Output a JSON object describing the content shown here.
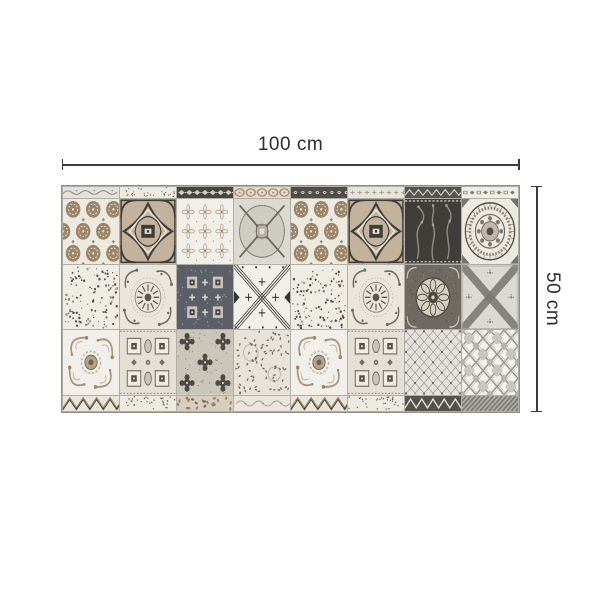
{
  "figure": {
    "width_label": "100 cm",
    "height_label": "50 cm",
    "line_color": "#3c3c3c",
    "text_color": "#2d2d2d",
    "background": "#ffffff"
  },
  "mat": {
    "description": "patchwork-cement-tile-mat",
    "columns": 8,
    "palette": {
      "grout": "#b0aea6",
      "mat_border": "#8f8e88",
      "cream": "#ece9e1",
      "offwhite": "#f1efe9",
      "taupe": "#9c8468",
      "tan": "#c3b29c",
      "brown": "#8a7258",
      "charcoal": "#3f3d38",
      "dark": "#45433d",
      "slate": "#5d5f68",
      "gray": "#8a887f",
      "lightgray": "#d9d6cd",
      "sage": "#6b695f",
      "ecru": "#e8e0d2",
      "stone": "#cfccc2"
    },
    "rows": [
      {
        "kind": "strip",
        "pattern_cells": [
          "st-scroll",
          "st-speckle",
          "st-darkdiamond",
          "st-circles",
          "st-darkfloret",
          "st-ornate",
          "st-zigzag",
          "st-motifs"
        ]
      },
      {
        "kind": "full",
        "pattern_cells": [
          "rosette-dots",
          "diamond-frame",
          "floral-lattice",
          "compass",
          "rosette-dots",
          "diamond-frame",
          "dark-damask",
          "mandala"
        ]
      },
      {
        "kind": "full",
        "pattern_cells": [
          "speckle",
          "sun-flower",
          "slate-geo",
          "x-arrows",
          "speckle",
          "sun-flower",
          "tapestry",
          "x-speckle"
        ]
      },
      {
        "kind": "full",
        "pattern_cells": [
          "baroque-swirl",
          "coffered",
          "dense-floral",
          "leaf-speckle",
          "baroque-swirl",
          "coffered",
          "mini-diamond",
          "trellis"
        ]
      },
      {
        "kind": "strip",
        "pattern_cells": [
          "chevron",
          "st-speckle",
          "band-brown",
          "ornate-light",
          "chevron",
          "st-speckle",
          "zigzag-dark",
          "diag-stripes"
        ]
      }
    ]
  }
}
